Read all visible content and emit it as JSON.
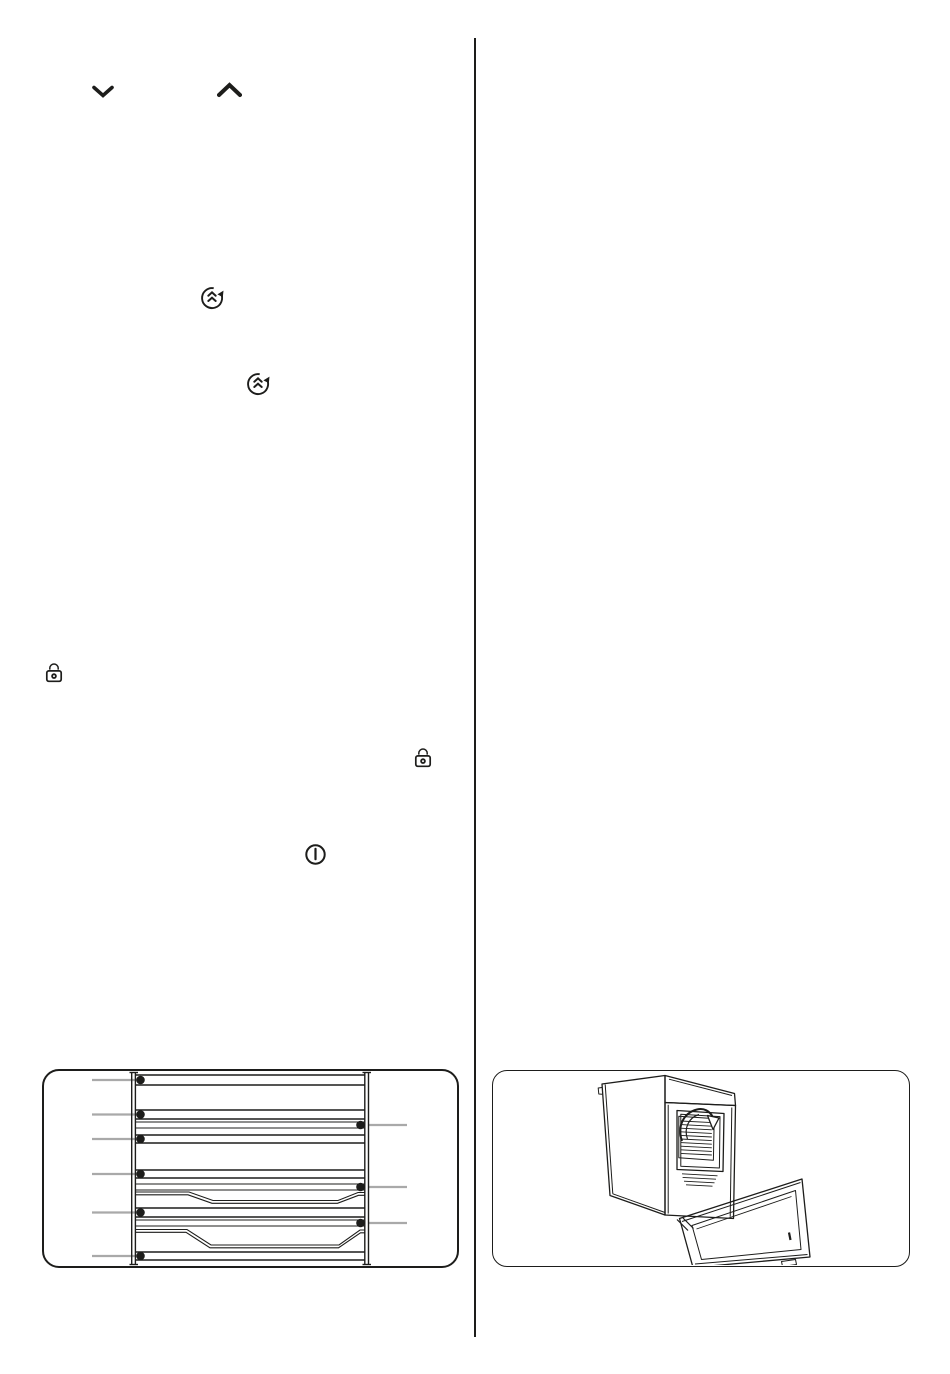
{
  "palette": {
    "ink": "#1d1d1b",
    "leader_gray": "#a9a9a9",
    "paper": "#ffffff"
  },
  "page": {
    "type": "oven-user-manual-page",
    "columns": 2,
    "visible_text": ""
  },
  "icons": {
    "chevron_down": {
      "name": "chevron-down-icon"
    },
    "chevron_up": {
      "name": "chevron-up-icon"
    },
    "fast_heat_up_1": {
      "name": "fast-heat-up-icon"
    },
    "fast_heat_up_2": {
      "name": "fast-heat-up-icon"
    },
    "lock_1": {
      "name": "lock-icon"
    },
    "lock_2": {
      "name": "lock-icon"
    },
    "power": {
      "name": "power-icon"
    }
  },
  "figures": {
    "shelf_diagram": {
      "name": "oven-shelf-positions-diagram",
      "left_callout_count": 6,
      "right_callout_count": 3,
      "tray_profile_count": 2
    },
    "oven_illustration": {
      "name": "oven-open-door-illustration"
    }
  }
}
